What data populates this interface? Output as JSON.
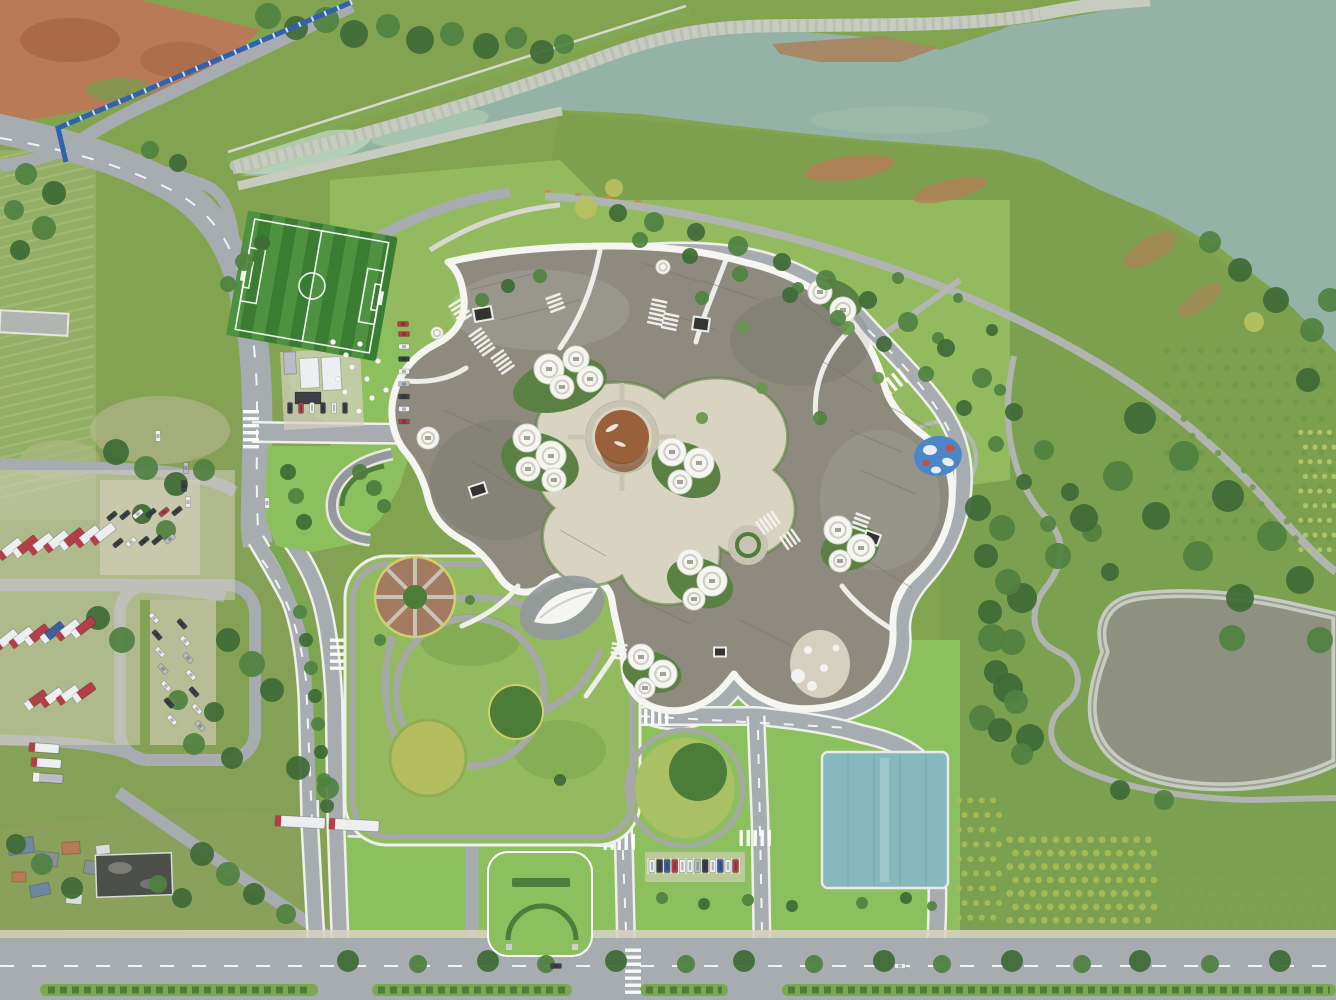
{
  "scene_type": "aerial-photograph",
  "palette": {
    "base": "#82a451",
    "baseDull": "#85a156",
    "lawn": "#8cbf5e",
    "lawnPark": "#93ba5f",
    "grassDull": "#7da04e",
    "grassDark": "#6d9845",
    "water": "#94b2a5",
    "waterLight": "#bcd6bd",
    "waterStreak": "#a8c4b2",
    "pondWater": "#8e9180",
    "stone": "#c7ccc1",
    "stoneDark": "#aeb4a8",
    "road": "#a7acb0",
    "roadLight": "#b5b9bc",
    "roadDark": "#93989c",
    "path": "#b0b5b2",
    "parkPath": "#a5aaa7",
    "pale": "#d8d8d0",
    "white": "#f3f4f1",
    "curb": "#eef0ea",
    "roof": "#8e8b7e",
    "roofDark": "#7d7a6e",
    "roofLight": "#9d9a8c",
    "plaza": "#d9d3c1",
    "plaza2": "#c9c3b1",
    "courtGreen": "#5b8044",
    "hedge": "#4d7c3b",
    "median": "#79a84e",
    "pondBrown": "#99613b",
    "pondBrownDk": "#7e4e2d",
    "fieldA": "#4e9140",
    "fieldB": "#3b7c33",
    "teal": "#87b8be",
    "tealDark": "#76a8ae",
    "fence": "#2f62ae",
    "dirt": "#b97a57",
    "dirtDk": "#a05f41",
    "mud": "#a9805c",
    "sand": "#d8d2c2",
    "tWhite": "#eceef0",
    "tRed": "#b23f48",
    "tBlue": "#3f5f9e",
    "tDark": "#3c4148",
    "tSilver": "#b9bec4",
    "t1": "#3f6b36",
    "t2": "#518141",
    "t3": "#67974b",
    "t4": "#b7c25e",
    "plant1": "#6f9a49",
    "plant2": "#b7c86a",
    "plant3": "#a8bd55",
    "plant4": "#7fa34c",
    "playBlue": "#4a86c8",
    "playRed": "#c05048",
    "yellowRim": "#cfd06a",
    "flower": "#b4bd5e",
    "circleBrown": "#a27a62",
    "circleGreen": "#4b7c38",
    "bench": "#c98a4b",
    "roofBlue": "#6f86a0",
    "roofGray2": "#8a8f96",
    "roofRust": "#b77b55",
    "roofWhite": "#dcdedd",
    "darkBld": "#4b4e49",
    "farmline": "#a9bf77"
  },
  "soccer": {
    "cx": 312,
    "cy": 286,
    "rot": 10,
    "w": 152,
    "h": 126,
    "stripes": 12
  },
  "farm_rows": {
    "x": 0,
    "y": 158,
    "w": 94,
    "h": 356,
    "gap": 10,
    "drop": 22
  },
  "boulevard_trees": {
    "x0": 348,
    "x1": 1330,
    "step": 66,
    "y": 961,
    "r": 11
  },
  "trees": [
    [
      268,
      16,
      13,
      "t2"
    ],
    [
      296,
      28,
      12,
      "t1"
    ],
    [
      326,
      20,
      13,
      "t2"
    ],
    [
      354,
      34,
      14,
      "t1"
    ],
    [
      388,
      26,
      12,
      "t2"
    ],
    [
      420,
      40,
      14,
      "t1"
    ],
    [
      452,
      34,
      12,
      "t2"
    ],
    [
      486,
      46,
      13,
      "t1"
    ],
    [
      516,
      38,
      11,
      "t2"
    ],
    [
      542,
      52,
      12,
      "t1"
    ],
    [
      564,
      44,
      10,
      "t2"
    ],
    [
      26,
      174,
      11,
      "t2"
    ],
    [
      54,
      193,
      12,
      "t1"
    ],
    [
      14,
      210,
      10,
      "t2"
    ],
    [
      44,
      228,
      12,
      "t2"
    ],
    [
      20,
      250,
      10,
      "t1"
    ],
    [
      150,
      150,
      9,
      "t2"
    ],
    [
      178,
      163,
      9,
      "t1"
    ],
    [
      244,
      262,
      9,
      "t2"
    ],
    [
      262,
      243,
      8,
      "t1"
    ],
    [
      228,
      284,
      8,
      "t2"
    ],
    [
      116,
      452,
      13,
      "t1"
    ],
    [
      146,
      468,
      12,
      "t2"
    ],
    [
      176,
      484,
      12,
      "t1"
    ],
    [
      204,
      470,
      11,
      "t2"
    ],
    [
      142,
      514,
      10,
      "t1"
    ],
    [
      166,
      530,
      10,
      "t2"
    ],
    [
      98,
      618,
      12,
      "t1"
    ],
    [
      122,
      640,
      13,
      "t2"
    ],
    [
      228,
      640,
      12,
      "t1"
    ],
    [
      252,
      664,
      13,
      "t2"
    ],
    [
      272,
      690,
      12,
      "t1"
    ],
    [
      232,
      758,
      11,
      "t1"
    ],
    [
      194,
      744,
      11,
      "t2"
    ],
    [
      214,
      712,
      10,
      "t1"
    ],
    [
      178,
      700,
      10,
      "t2"
    ],
    [
      298,
      768,
      12,
      "t1"
    ],
    [
      328,
      788,
      11,
      "t2"
    ],
    [
      16,
      844,
      10,
      "t1"
    ],
    [
      42,
      864,
      11,
      "t2"
    ],
    [
      72,
      888,
      11,
      "t1"
    ],
    [
      202,
      854,
      12,
      "t1"
    ],
    [
      228,
      874,
      12,
      "t2"
    ],
    [
      254,
      894,
      11,
      "t1"
    ],
    [
      286,
      914,
      10,
      "t2"
    ],
    [
      182,
      898,
      10,
      "t1"
    ],
    [
      158,
      884,
      9,
      "t2"
    ],
    [
      702,
      298,
      7,
      "t2"
    ],
    [
      744,
      328,
      6,
      "t3"
    ],
    [
      798,
      288,
      6,
      "t2"
    ],
    [
      848,
      328,
      7,
      "t3"
    ],
    [
      898,
      278,
      6,
      "t2"
    ],
    [
      762,
      388,
      6,
      "t3"
    ],
    [
      820,
      418,
      7,
      "t2"
    ],
    [
      878,
      378,
      6,
      "t3"
    ],
    [
      938,
      338,
      6,
      "t2"
    ],
    [
      702,
      418,
      6,
      "t3"
    ],
    [
      958,
      298,
      5,
      "t2"
    ],
    [
      992,
      330,
      6,
      "t1"
    ],
    [
      1000,
      390,
      6,
      "t2"
    ],
    [
      586,
      208,
      11,
      "t4"
    ],
    [
      614,
      188,
      9,
      "t4"
    ],
    [
      1254,
      322,
      10,
      "t4"
    ],
    [
      618,
      213,
      9,
      "t1"
    ],
    [
      654,
      222,
      10,
      "t2"
    ],
    [
      696,
      232,
      9,
      "t1"
    ],
    [
      738,
      246,
      10,
      "t2"
    ],
    [
      782,
      262,
      9,
      "t1"
    ],
    [
      826,
      280,
      10,
      "t2"
    ],
    [
      868,
      300,
      9,
      "t1"
    ],
    [
      908,
      322,
      10,
      "t2"
    ],
    [
      946,
      348,
      9,
      "t1"
    ],
    [
      982,
      378,
      10,
      "t2"
    ],
    [
      1014,
      412,
      9,
      "t1"
    ],
    [
      1044,
      450,
      10,
      "t2"
    ],
    [
      1070,
      492,
      9,
      "t1"
    ],
    [
      1092,
      532,
      10,
      "t2"
    ],
    [
      1110,
      572,
      9,
      "t1"
    ],
    [
      640,
      240,
      8,
      "t2"
    ],
    [
      690,
      256,
      8,
      "t1"
    ],
    [
      740,
      274,
      8,
      "t2"
    ],
    [
      790,
      295,
      8,
      "t1"
    ],
    [
      838,
      318,
      8,
      "t2"
    ],
    [
      884,
      344,
      8,
      "t1"
    ],
    [
      926,
      374,
      8,
      "t2"
    ],
    [
      964,
      408,
      8,
      "t1"
    ],
    [
      996,
      444,
      8,
      "t2"
    ],
    [
      1024,
      482,
      8,
      "t1"
    ],
    [
      1048,
      524,
      8,
      "t2"
    ],
    [
      1140,
      418,
      16,
      "t1"
    ],
    [
      1184,
      456,
      15,
      "t2"
    ],
    [
      1228,
      496,
      16,
      "t1"
    ],
    [
      1272,
      536,
      15,
      "t2"
    ],
    [
      1156,
      516,
      14,
      "t1"
    ],
    [
      1198,
      556,
      15,
      "t2"
    ],
    [
      1240,
      598,
      14,
      "t1"
    ],
    [
      1118,
      476,
      15,
      "t2"
    ],
    [
      1084,
      518,
      14,
      "t1"
    ],
    [
      1058,
      556,
      13,
      "t2"
    ],
    [
      1022,
      598,
      15,
      "t1"
    ],
    [
      992,
      638,
      14,
      "t2"
    ],
    [
      1008,
      688,
      15,
      "t1"
    ],
    [
      982,
      718,
      13,
      "t2"
    ],
    [
      1030,
      738,
      14,
      "t1"
    ],
    [
      1232,
      638,
      13,
      "t2"
    ],
    [
      1300,
      580,
      14,
      "t1"
    ],
    [
      1320,
      640,
      13,
      "t2"
    ],
    [
      1276,
      300,
      13,
      "t1"
    ],
    [
      1312,
      330,
      12,
      "t2"
    ],
    [
      1240,
      270,
      12,
      "t1"
    ],
    [
      1210,
      242,
      11,
      "t2"
    ],
    [
      1308,
      380,
      12,
      "t1"
    ],
    [
      1330,
      300,
      12,
      "t2"
    ],
    [
      978,
      508,
      13,
      "t1"
    ],
    [
      1002,
      528,
      13,
      "t2"
    ],
    [
      986,
      556,
      12,
      "t1"
    ],
    [
      1008,
      582,
      13,
      "t2"
    ],
    [
      990,
      612,
      12,
      "t1"
    ],
    [
      1012,
      642,
      13,
      "t2"
    ],
    [
      996,
      672,
      12,
      "t1"
    ],
    [
      1016,
      702,
      12,
      "t2"
    ],
    [
      1000,
      730,
      12,
      "t1"
    ],
    [
      1022,
      754,
      11,
      "t2"
    ],
    [
      1120,
      790,
      10,
      "t1"
    ],
    [
      1164,
      800,
      10,
      "t2"
    ],
    [
      300,
      612,
      7,
      "t2"
    ],
    [
      306,
      640,
      7,
      "t1"
    ],
    [
      311,
      668,
      7,
      "t2"
    ],
    [
      315,
      696,
      7,
      "t1"
    ],
    [
      318,
      724,
      7,
      "t2"
    ],
    [
      321,
      752,
      7,
      "t1"
    ],
    [
      324,
      780,
      7,
      "t2"
    ],
    [
      327,
      806,
      7,
      "t1"
    ],
    [
      662,
      898,
      6,
      "t2"
    ],
    [
      704,
      904,
      6,
      "t1"
    ],
    [
      748,
      900,
      6,
      "t2"
    ],
    [
      792,
      906,
      6,
      "t1"
    ],
    [
      862,
      903,
      6,
      "t2"
    ],
    [
      906,
      898,
      6,
      "t1"
    ],
    [
      932,
      906,
      5,
      "t2"
    ],
    [
      482,
      300,
      7,
      "t2"
    ],
    [
      508,
      286,
      7,
      "t1"
    ],
    [
      540,
      276,
      7,
      "t2"
    ],
    [
      380,
      640,
      6,
      "t2"
    ],
    [
      560,
      780,
      6,
      "t1"
    ],
    [
      470,
      600,
      5,
      "t2"
    ],
    [
      288,
      472,
      8,
      "t1"
    ],
    [
      296,
      496,
      8,
      "t2"
    ],
    [
      304,
      522,
      8,
      "t1"
    ],
    [
      360,
      472,
      8,
      "hedge"
    ],
    [
      374,
      488,
      8,
      "hedge"
    ],
    [
      384,
      506,
      7,
      "hedge"
    ]
  ],
  "plant_blocks": [
    {
      "x": 1158,
      "y": 342,
      "w": 172,
      "h": 205,
      "cols": 10,
      "rows": 12,
      "c": "plant1",
      "r": 3.2
    },
    {
      "x": 1296,
      "y": 425,
      "w": 38,
      "h": 132,
      "cols": 4,
      "rows": 9,
      "c": "plant2",
      "r": 2.6
    },
    {
      "x": 1004,
      "y": 833,
      "w": 150,
      "h": 94,
      "cols": 13,
      "rows": 7,
      "c": "plant3",
      "r": 3.4
    },
    {
      "x": 1166,
      "y": 872,
      "w": 164,
      "h": 58,
      "cols": 14,
      "rows": 4,
      "c": "plant4",
      "r": 3
    },
    {
      "x": 953,
      "y": 793,
      "w": 46,
      "h": 132,
      "cols": 4,
      "rows": 9,
      "c": "plant3",
      "r": 3
    }
  ],
  "truck_rows": [
    {
      "x": 10,
      "y": 549,
      "a": -38,
      "n": 7,
      "dx": 15.5,
      "dy": -2.5,
      "w": 27,
      "h": 9,
      "cs": [
        "tWhite",
        "tRed",
        "tWhite",
        "tWhite",
        "tRed",
        "tWhite",
        "tWhite"
      ]
    },
    {
      "x": 6,
      "y": 640,
      "a": -38,
      "n": 6,
      "dx": 15.5,
      "dy": -2.5,
      "w": 26,
      "h": 9,
      "cs": [
        "tWhite",
        "tWhite",
        "tRed",
        "tBlue",
        "tWhite",
        "tRed"
      ]
    },
    {
      "x": 36,
      "y": 700,
      "a": -36,
      "n": 4,
      "dx": 16,
      "dy": -2.5,
      "w": 24,
      "h": 9,
      "cs": [
        "tRed",
        "tWhite",
        "tWhite",
        "tRed"
      ]
    },
    {
      "x": 44,
      "y": 748,
      "a": 4,
      "n": 3,
      "dx": 2,
      "dy": 15,
      "w": 30,
      "h": 9,
      "cs": [
        "tWhite",
        "tWhite",
        "tSilver"
      ]
    },
    {
      "x": 300,
      "y": 822,
      "a": 3,
      "n": 2,
      "dx": 54,
      "dy": 3,
      "w": 50,
      "h": 11,
      "cs": [
        "tWhite",
        "tWhite"
      ]
    }
  ],
  "car_rows": [
    {
      "x": 112,
      "y": 516,
      "a": -40,
      "n": 6,
      "dx": 13,
      "dy": -1,
      "w": 11,
      "h": 5,
      "cs": [
        "tDark",
        "tDark",
        "tWhite",
        "tDark",
        "tRed",
        "tDark"
      ]
    },
    {
      "x": 118,
      "y": 543,
      "a": -40,
      "n": 5,
      "dx": 13,
      "dy": -1,
      "w": 11,
      "h": 5,
      "cs": [
        "tDark",
        "tWhite",
        "tDark",
        "tDark",
        "tSilver"
      ]
    },
    {
      "x": 154,
      "y": 618,
      "a": 48,
      "n": 7,
      "dx": 3,
      "dy": 17,
      "w": 11,
      "h": 5,
      "cs": [
        "tWhite",
        "tDark",
        "tWhite",
        "tSilver",
        "tWhite",
        "tDark",
        "tWhite"
      ]
    },
    {
      "x": 182,
      "y": 624,
      "a": 48,
      "n": 7,
      "dx": 3,
      "dy": 17,
      "w": 11,
      "h": 5,
      "cs": [
        "tDark",
        "tWhite",
        "tSilver",
        "tWhite",
        "tDark",
        "tWhite",
        "tSilver"
      ]
    },
    {
      "x": 404,
      "y": 334,
      "a": 0,
      "n": 8,
      "dx": 0,
      "dy": 12.5,
      "w": 11,
      "h": 5,
      "cs": [
        "tRed",
        "tWhite",
        "tDark",
        "tWhite",
        "tSilver",
        "tDark",
        "tWhite",
        "tRed"
      ]
    },
    {
      "x": 290,
      "y": 408,
      "a": 0,
      "n": 6,
      "dx": 11,
      "dy": 0,
      "w": 5,
      "h": 11,
      "cs": [
        "tDark",
        "tRed",
        "tWhite",
        "tDark",
        "tWhite",
        "tDark"
      ]
    },
    {
      "x": 652,
      "y": 866,
      "a": 0,
      "n": 12,
      "dx": 7.6,
      "dy": 0,
      "w": 6,
      "h": 13,
      "stalls": true,
      "cs": [
        "tWhite",
        "tDark",
        "tBlue",
        "tRed",
        "tWhite",
        "tWhite",
        "tSilver",
        "tDark",
        "tWhite",
        "tBlue",
        "tWhite",
        "tRed"
      ]
    }
  ],
  "loose_cars": [
    [
      267,
      503,
      88,
      "tWhite"
    ],
    [
      184,
      486,
      88,
      "tDark"
    ],
    [
      188,
      502,
      88,
      "tWhite"
    ],
    [
      186,
      468,
      88,
      "tSilver"
    ],
    [
      403,
      324,
      0,
      "tRed"
    ],
    [
      158,
      436,
      88,
      "tWhite"
    ],
    [
      900,
      966,
      0,
      "tWhite"
    ],
    [
      556,
      966,
      0,
      "tDark"
    ]
  ],
  "pods": [
    [
      549,
      369,
      15
    ],
    [
      576,
      359,
      13
    ],
    [
      562,
      387,
      12
    ],
    [
      590,
      379,
      13
    ],
    [
      527,
      438,
      14
    ],
    [
      551,
      456,
      15
    ],
    [
      528,
      469,
      12
    ],
    [
      554,
      480,
      12
    ],
    [
      672,
      452,
      14
    ],
    [
      699,
      463,
      15
    ],
    [
      680,
      482,
      12
    ],
    [
      690,
      562,
      13
    ],
    [
      712,
      581,
      15
    ],
    [
      694,
      599,
      11
    ],
    [
      641,
      657,
      13
    ],
    [
      663,
      674,
      14
    ],
    [
      645,
      688,
      10
    ],
    [
      838,
      530,
      14
    ],
    [
      861,
      548,
      14
    ],
    [
      840,
      561,
      11
    ],
    [
      820,
      292,
      12
    ],
    [
      843,
      310,
      13
    ],
    [
      428,
      438,
      11
    ],
    [
      437,
      333,
      6
    ],
    [
      663,
      267,
      7
    ]
  ],
  "skylights": [
    [
      483,
      314,
      18,
      13,
      -10
    ],
    [
      701,
      324,
      16,
      13,
      8
    ],
    [
      478,
      490,
      16,
      11,
      -18
    ],
    [
      872,
      538,
      15,
      11,
      20
    ],
    [
      720,
      652,
      12,
      9,
      0
    ]
  ],
  "louvers": [
    [
      468,
      336,
      -35,
      6
    ],
    [
      490,
      358,
      -35,
      5
    ],
    [
      652,
      298,
      12,
      6
    ],
    [
      664,
      312,
      12,
      4
    ],
    [
      772,
      510,
      55,
      5
    ],
    [
      792,
      528,
      55,
      4
    ],
    [
      856,
      512,
      20,
      4
    ],
    [
      612,
      642,
      8,
      4
    ],
    [
      545,
      298,
      -20,
      4
    ],
    [
      448,
      306,
      -32,
      5
    ]
  ],
  "grid_lines": [
    [
      470,
      290,
      540,
      272
    ],
    [
      500,
      320,
      580,
      300
    ],
    [
      640,
      262,
      700,
      282
    ],
    [
      700,
      280,
      760,
      300
    ],
    [
      660,
      310,
      716,
      330
    ],
    [
      800,
      300,
      846,
      336
    ],
    [
      820,
      360,
      872,
      392
    ],
    [
      850,
      430,
      902,
      452
    ],
    [
      860,
      470,
      916,
      494
    ],
    [
      866,
      560,
      912,
      588
    ],
    [
      640,
      600,
      690,
      624
    ],
    [
      560,
      530,
      606,
      556
    ],
    [
      470,
      460,
      516,
      488
    ],
    [
      444,
      410,
      492,
      432
    ],
    [
      740,
      620,
      792,
      646
    ],
    [
      884,
      404,
      930,
      428
    ]
  ],
  "zebras": [
    [
      251,
      431,
      90,
      6
    ],
    [
      478,
      434,
      0,
      6
    ],
    [
      651,
      717,
      0,
      6
    ],
    [
      757,
      838,
      0,
      5
    ],
    [
      621,
      842,
      0,
      5
    ],
    [
      338,
      656,
      90,
      5
    ],
    [
      633,
      973,
      90,
      7
    ],
    [
      893,
      383,
      -38,
      5
    ]
  ],
  "sheep": [
    [
      333,
      342
    ],
    [
      346,
      355
    ],
    [
      360,
      344
    ],
    [
      352,
      367
    ],
    [
      338,
      379
    ],
    [
      367,
      379
    ],
    [
      378,
      361
    ],
    [
      386,
      390
    ],
    [
      372,
      398
    ],
    [
      359,
      411
    ],
    [
      345,
      392
    ]
  ],
  "benches": [
    [
      545,
      190
    ],
    [
      575,
      193
    ],
    [
      605,
      196
    ],
    [
      635,
      200
    ]
  ],
  "shanty_buildings": [
    [
      8,
      838,
      26,
      16,
      -8,
      "roofBlue"
    ],
    [
      36,
      852,
      22,
      14,
      6,
      "roofGray2"
    ],
    [
      62,
      842,
      18,
      12,
      -4,
      "roofRust"
    ],
    [
      84,
      862,
      24,
      13,
      10,
      "roofGray2"
    ],
    [
      30,
      884,
      20,
      12,
      -12,
      "roofBlue"
    ],
    [
      66,
      894,
      16,
      10,
      5,
      "roofWhite"
    ],
    [
      12,
      872,
      14,
      10,
      0,
      "roofRust"
    ],
    [
      96,
      845,
      14,
      9,
      -6,
      "roofWhite"
    ],
    [
      118,
      860,
      16,
      10,
      8,
      "roofGray2"
    ]
  ],
  "containers": [
    [
      300,
      358,
      19,
      30,
      -3,
      "tWhite"
    ],
    [
      322,
      357,
      19,
      33,
      -3,
      "tWhite"
    ],
    [
      284,
      352,
      12,
      22,
      -3,
      "tSilver"
    ],
    [
      295,
      392,
      26,
      12,
      0,
      "tDark"
    ]
  ]
}
